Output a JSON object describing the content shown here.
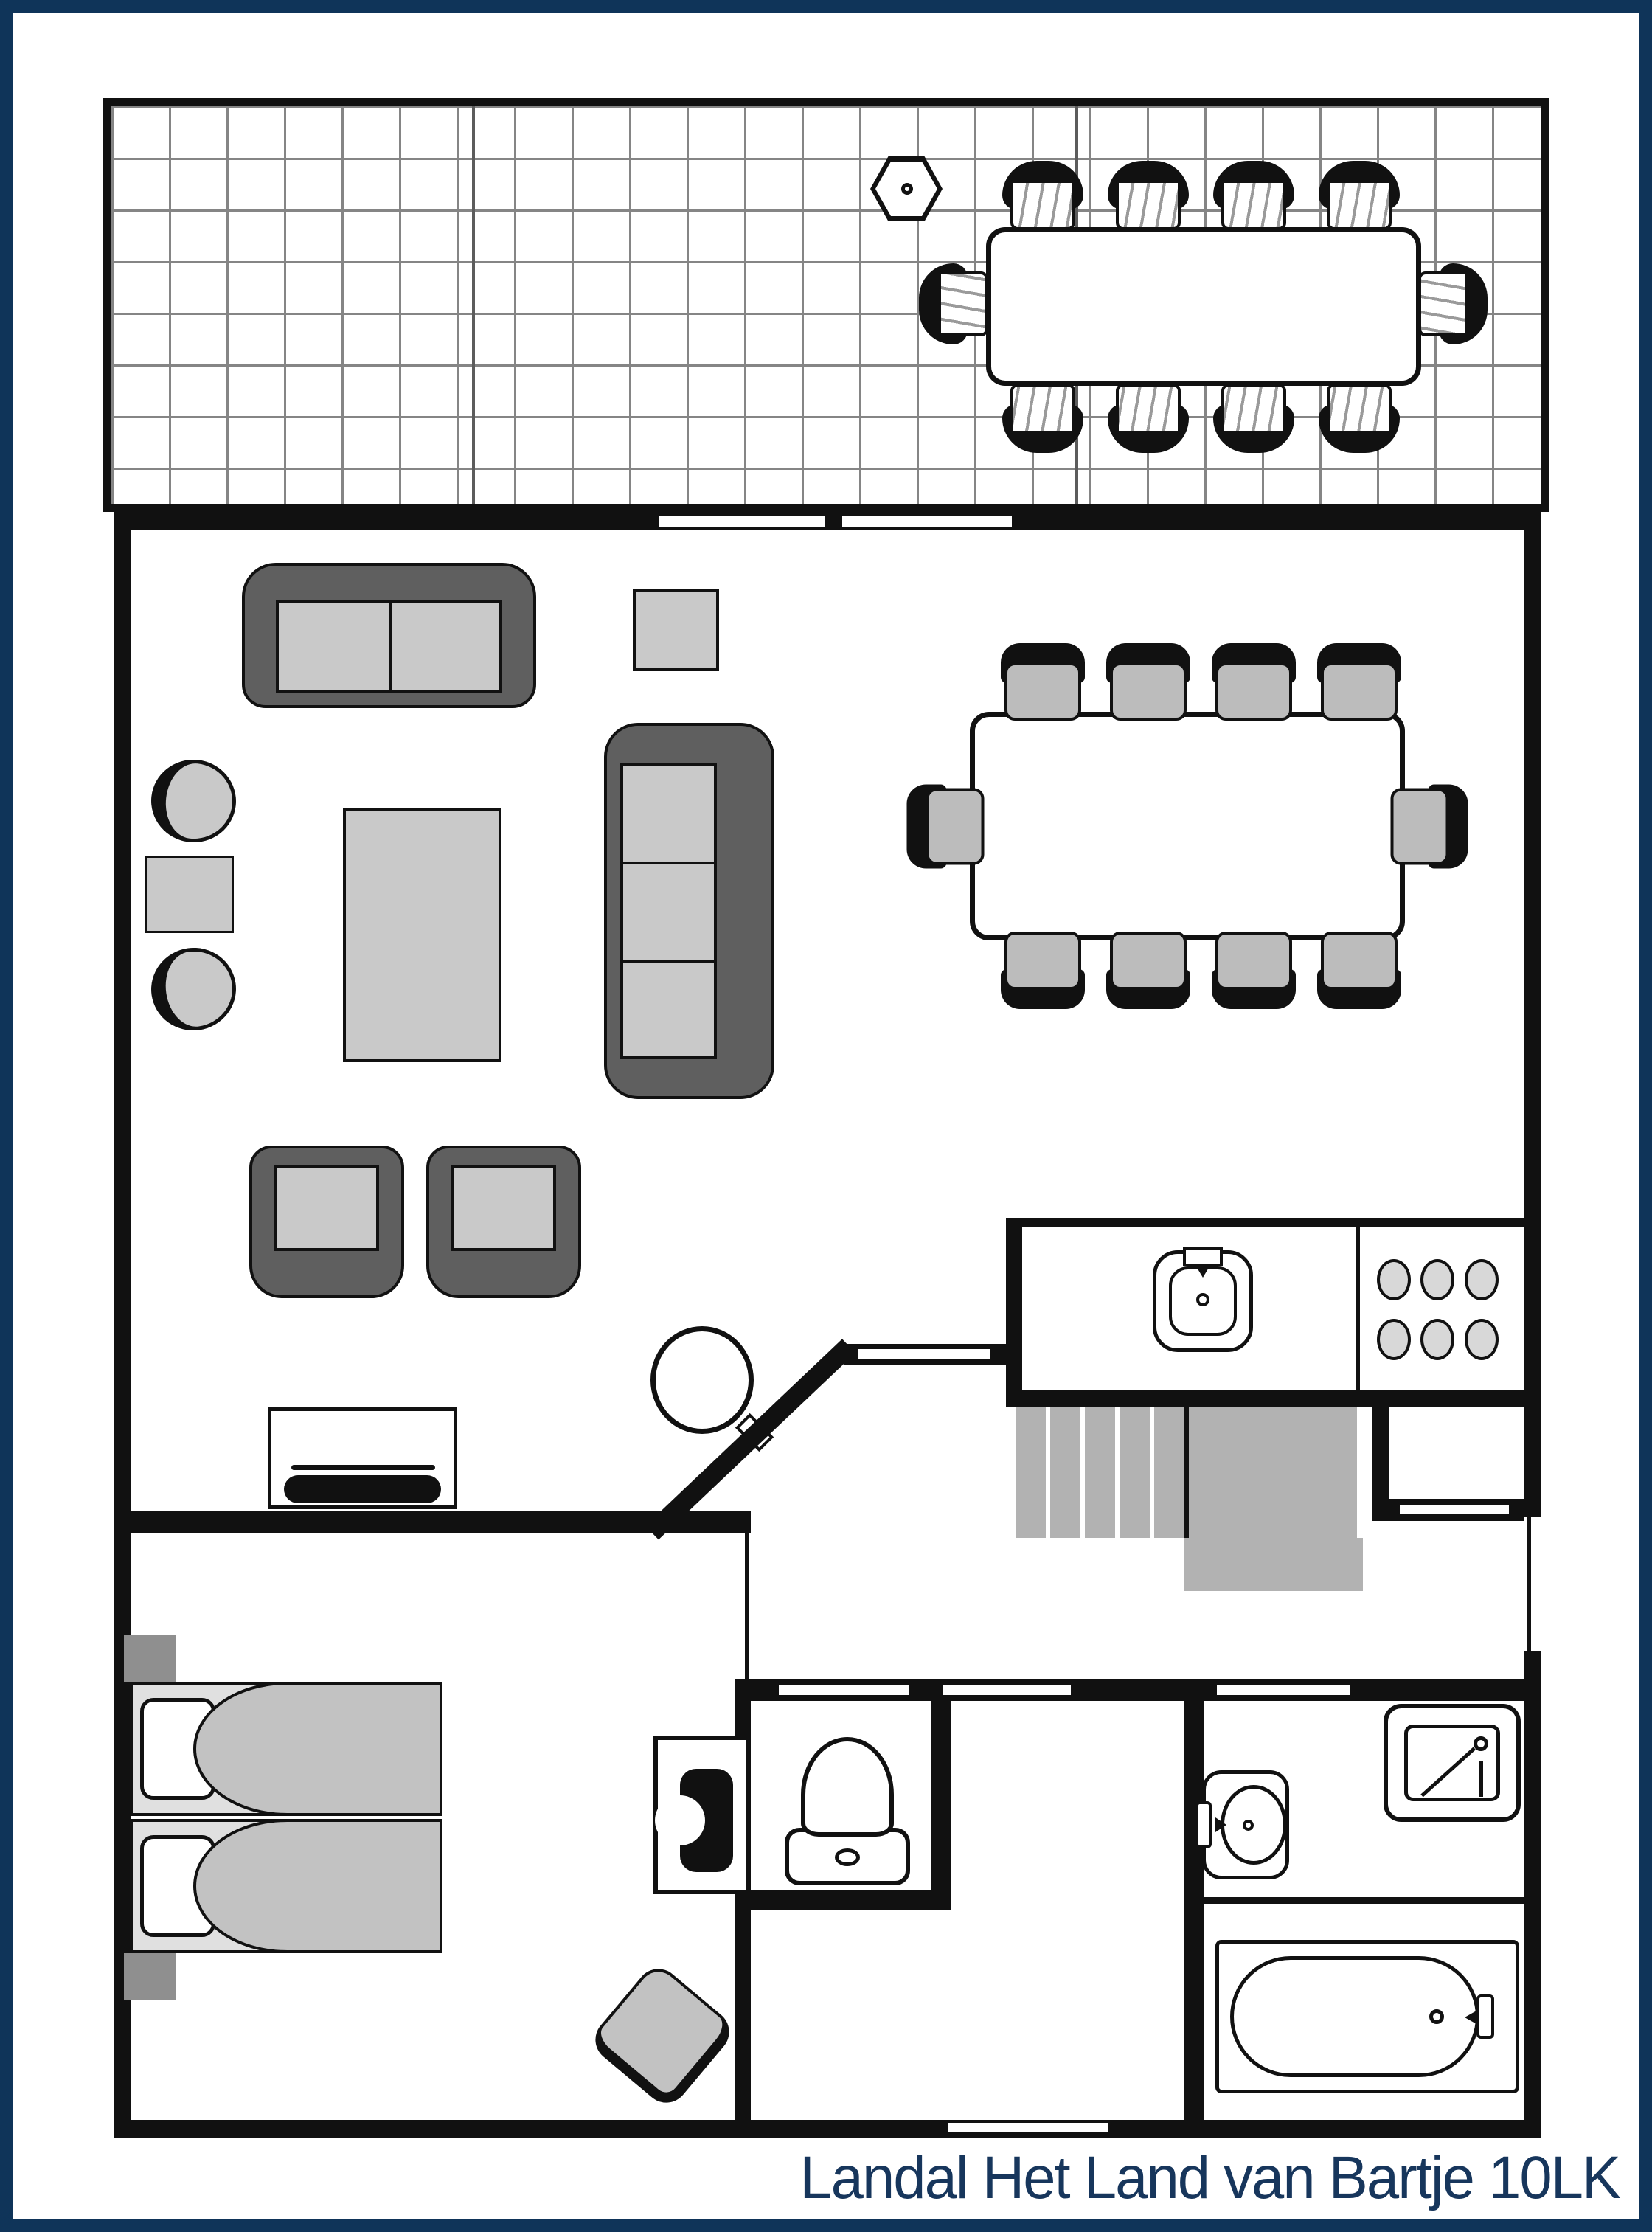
{
  "title": "Landal Het Land van Bartje 10LK",
  "colors": {
    "navy_frame": "#0f3459",
    "navy_text": "#17365c",
    "ink": "#111111",
    "sofa_dark": "#5f5f5f",
    "cushion_gray": "#c9c9c9",
    "seat_gray": "#bcbcbc",
    "stairs_gray": "#b2b2b2",
    "grid_gray": "#858585",
    "burner_gray": "#d8d8d8",
    "nightstand_gray": "#8f8f8f",
    "mattress_gray": "#e0e0e0",
    "blanket_gray": "#c2c2c2",
    "stool_gray": "#c2c2c2"
  },
  "plan": {
    "terrace": {
      "floor": "tiled grid",
      "dining_table": 1,
      "dining_chairs": 10,
      "parasol_base": 1
    },
    "living_room": {
      "two_seat_sofa": 1,
      "three_seat_sofa": 1,
      "armchairs": 2,
      "lounge_chairs": 2,
      "coffee_table": 1,
      "side_tables": 2,
      "tv_cabinet": 1,
      "wood_stove": 1
    },
    "dining_area": {
      "table": 1,
      "chairs": 10
    },
    "kitchen": {
      "sink": 1,
      "hob_burners": 6,
      "counter": 1
    },
    "hall": {
      "stairs": 1,
      "front_door": 1,
      "cupboard_niche": 1
    },
    "bedroom": {
      "double_bed": 1,
      "pillows": 2,
      "nightstands": 2,
      "cot": 1,
      "stool": 1
    },
    "toilet_room": {
      "toilet": 1
    },
    "bathroom": {
      "shower": 1,
      "washbasin": 1,
      "bathtub": 1
    }
  }
}
